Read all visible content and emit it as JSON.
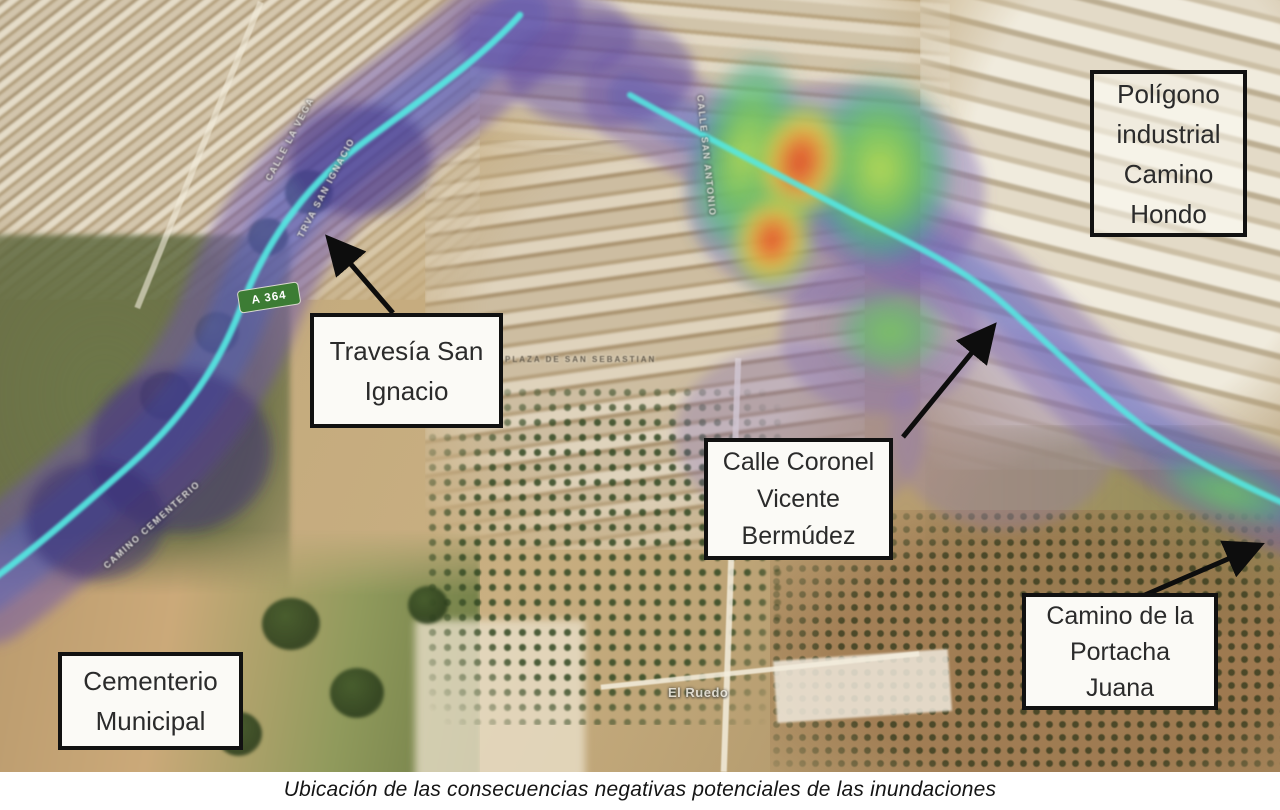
{
  "caption": "Ubicación de las consecuencias negativas potenciales de las inundaciones",
  "map": {
    "callouts": [
      {
        "id": "poligono-industrial",
        "label": "Polígono industrial Camino Hondo",
        "lines": [
          "Polígono",
          "industrial",
          "Camino",
          "Hondo"
        ]
      },
      {
        "id": "travesia-san-ignacio",
        "label": "Travesía San Ignacio",
        "lines": [
          "Travesía San",
          "Ignacio"
        ]
      },
      {
        "id": "calle-coronel-vicente-bermudez",
        "label": "Calle Coronel Vicente Bermúdez",
        "lines": [
          "Calle Coronel",
          "Vicente",
          "Bermúdez"
        ]
      },
      {
        "id": "camino-de-la-portacha-juana",
        "label": "Camino de la Portacha Juana",
        "lines": [
          "Camino de la",
          "Portacha",
          "Juana"
        ]
      },
      {
        "id": "cementerio-municipal",
        "label": "Cementerio Municipal",
        "lines": [
          "Cementerio",
          "Municipal"
        ]
      }
    ],
    "road_sign": "A 364",
    "street_labels": [
      "TRVA SAN IGNACIO",
      "CALLE LA VEGA",
      "CALLE SAN ANTONIO",
      "PLAZA DE SAN SEBASTIAN",
      "CAMINO CEMENTERIO",
      "El Ruedo"
    ],
    "colors": {
      "flood_shallow_purple": "#7b64b4",
      "flood_channel_blue": "#4c66c8",
      "stream_line_cyan": "#52e6e0",
      "depth_low_green": "#6cc95a",
      "depth_mid_yellow": "#d9d84e",
      "depth_high_orange": "#ef8f3a",
      "depth_max_red": "#e2472e",
      "callout_border": "#111111",
      "callout_background": "#ffffff",
      "road_sign_background": "#3c7c34",
      "road_sign_text": "#ffffff"
    }
  }
}
